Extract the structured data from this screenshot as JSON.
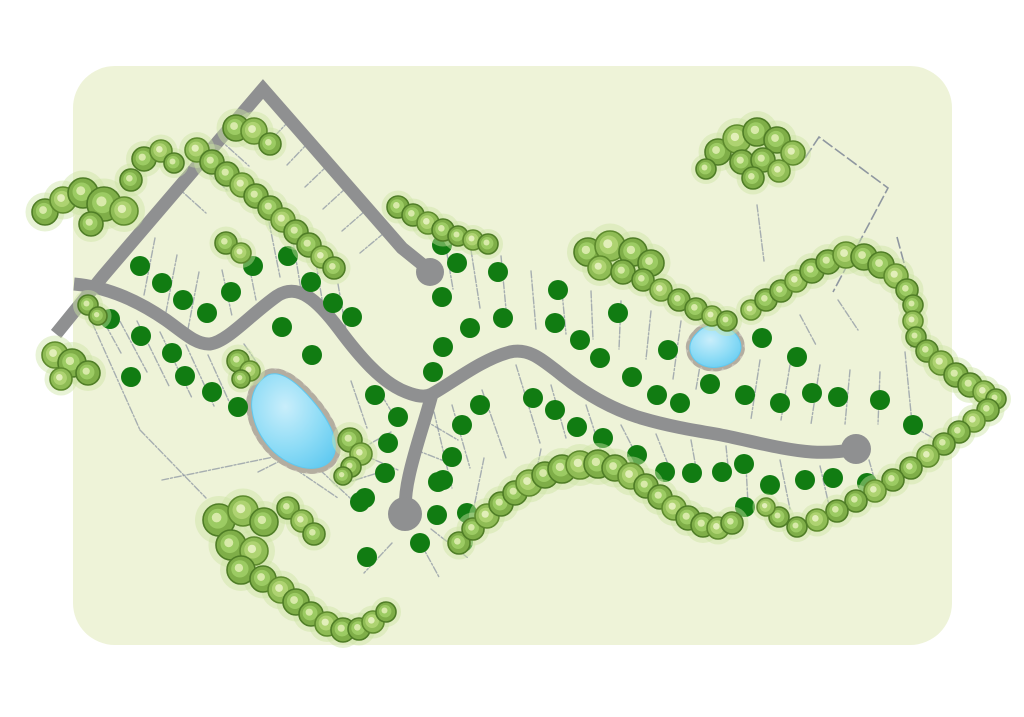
{
  "page": {
    "background": "#ffffff"
  },
  "panel": {
    "x": 73,
    "y": 66,
    "w": 879,
    "h": 579,
    "radius": 42,
    "fill": "#eef3d8"
  },
  "palette": {
    "road": "#8f9091",
    "lot_line": "#8790a0",
    "boundary_line": "#7e8696",
    "dot": "#117c12",
    "tree_dark": "#4f7d26",
    "tree_mid": "#7fae48",
    "tree_inner": "#9ccb63",
    "tree_light": "#d8eaa9",
    "tree_dark2": "#5d8a2d",
    "tree_mid2": "#8fbc55",
    "tree_inner2": "#aed371",
    "tree_light2": "#e2efb9",
    "tree_fringe": "#cde5a3",
    "pond_water": "#8edcf6",
    "pond_water_light": "#c9eefb",
    "pond_water_deep": "#5fc9f0",
    "pond_rim": "#c9c4b9",
    "pond_rim_dash": "#b3ada0"
  },
  "roads": {
    "width": 13,
    "north_road_points": "56,334 103,276 263,89 402,248 423,265",
    "main_road_path": "M 74 284 C 108 287 140 302 166 320 C 183 332 196 345 210 344 C 227 342 250 315 277 296 C 298 282 318 301 339 329 C 359 356 382 383 406 392 C 416 396 425 398 432 394 C 452 383 482 359 510 352 C 528 348 540 358 558 372 C 580 390 608 408 641 418 C 668 426 692 430 716 434 C 748 440 782 450 812 452 C 830 453 846 451 856 449",
    "south_spur_path": "M 432 394 C 426 418 415 448 409 476 C 406 489 405 500 405 512",
    "bulbs": [
      [
        430,
        272,
        14
      ],
      [
        405,
        514,
        17
      ],
      [
        856,
        449,
        15
      ]
    ]
  },
  "boundary_polylines": [
    [
      [
        805,
        158
      ],
      [
        819,
        137
      ],
      [
        888,
        188
      ],
      [
        833,
        292
      ]
    ],
    [
      [
        897,
        237
      ],
      [
        914,
        300
      ],
      [
        911,
        348
      ]
    ]
  ],
  "lot_lines": [
    [
      289,
      121,
      268,
      143
    ],
    [
      308,
      143,
      287,
      165
    ],
    [
      327,
      166,
      305,
      187
    ],
    [
      346,
      188,
      323,
      209
    ],
    [
      365,
      211,
      342,
      231
    ],
    [
      384,
      233,
      360,
      253
    ],
    [
      176,
      186,
      206,
      213
    ],
    [
      197,
      163,
      227,
      190
    ],
    [
      219,
      139,
      249,
      166
    ],
    [
      240,
      116,
      270,
      143
    ],
    [
      155,
      238,
      144,
      295
    ],
    [
      177,
      255,
      166,
      312
    ],
    [
      199,
      272,
      188,
      329
    ],
    [
      222,
      270,
      232,
      316
    ],
    [
      245,
      245,
      256,
      300
    ],
    [
      269,
      222,
      280,
      277
    ],
    [
      293,
      241,
      301,
      290
    ],
    [
      316,
      263,
      324,
      311
    ],
    [
      338,
      284,
      346,
      330
    ],
    [
      93,
      302,
      121,
      353
    ],
    [
      114,
      310,
      147,
      372
    ],
    [
      137,
      321,
      169,
      386
    ],
    [
      160,
      332,
      192,
      398
    ],
    [
      82,
      300,
      140,
      430
    ],
    [
      140,
      430,
      206,
      498
    ],
    [
      186,
      345,
      214,
      406
    ],
    [
      208,
      355,
      232,
      408
    ],
    [
      244,
      344,
      259,
      366
    ],
    [
      351,
      381,
      367,
      428
    ],
    [
      320,
      470,
      350,
      498
    ],
    [
      258,
      472,
      286,
      458
    ],
    [
      352,
      450,
      398,
      470
    ],
    [
      452,
      405,
      470,
      468
    ],
    [
      482,
      390,
      506,
      458
    ],
    [
      516,
      365,
      540,
      443
    ],
    [
      551,
      385,
      566,
      438
    ],
    [
      586,
      405,
      600,
      448
    ],
    [
      621,
      425,
      638,
      458
    ],
    [
      656,
      434,
      668,
      464
    ],
    [
      691,
      440,
      696,
      468
    ],
    [
      726,
      446,
      729,
      476
    ],
    [
      434,
      412,
      452,
      488
    ],
    [
      484,
      458,
      473,
      512
    ],
    [
      541,
      449,
      531,
      497
    ],
    [
      447,
      254,
      453,
      289
    ],
    [
      471,
      250,
      480,
      308
    ],
    [
      501,
      256,
      506,
      309
    ],
    [
      531,
      271,
      536,
      329
    ],
    [
      561,
      281,
      566,
      334
    ],
    [
      591,
      291,
      593,
      339
    ],
    [
      621,
      301,
      619,
      349
    ],
    [
      651,
      311,
      646,
      359
    ],
    [
      681,
      321,
      673,
      379
    ],
    [
      706,
      331,
      696,
      389
    ],
    [
      757,
      205,
      764,
      261
    ],
    [
      838,
      300,
      858,
      330
    ],
    [
      800,
      315,
      816,
      345
    ],
    [
      760,
      360,
      751,
      419
    ],
    [
      790,
      365,
      781,
      420
    ],
    [
      820,
      365,
      811,
      424
    ],
    [
      850,
      370,
      845,
      424
    ],
    [
      880,
      372,
      878,
      424
    ],
    [
      905,
      352,
      912,
      423
    ],
    [
      869,
      460,
      880,
      499
    ],
    [
      820,
      466,
      831,
      514
    ],
    [
      780,
      460,
      790,
      509
    ],
    [
      746,
      466,
      748,
      504
    ],
    [
      914,
      427,
      938,
      441
    ],
    [
      424,
      420,
      458,
      440
    ],
    [
      416,
      450,
      452,
      464
    ],
    [
      391,
      432,
      357,
      451
    ],
    [
      387,
      470,
      352,
      481
    ],
    [
      392,
      543,
      364,
      573
    ],
    [
      421,
      544,
      439,
      577
    ],
    [
      431,
      529,
      468,
      558
    ],
    [
      399,
      424,
      382,
      396
    ],
    [
      283,
      455,
      162,
      480
    ],
    [
      285,
      462,
      338,
      498
    ]
  ],
  "ponds": [
    {
      "name": "large-pond",
      "water_path": "M 268 375 C 256 382 250 396 252 410 C 254 426 262 440 274 452 C 286 463 302 470 316 468 C 330 466 337 456 335 442 C 333 428 324 414 312 400 C 300 386 282 369 268 375 Z",
      "rim_width": 11
    },
    {
      "name": "small-pond",
      "water_path": "M 697 333 C 703 326 714 323 724 327 C 734 330 741 338 741 348 C 740 358 731 365 719 367 C 707 369 695 364 691 354 C 688 346 691 339 697 333 Z",
      "rim_width": 8
    }
  ],
  "lot_markers": {
    "radius": 10,
    "points": [
      [
        140,
        266
      ],
      [
        162,
        283
      ],
      [
        183,
        300
      ],
      [
        207,
        313
      ],
      [
        231,
        292
      ],
      [
        253,
        266
      ],
      [
        288,
        256
      ],
      [
        311,
        282
      ],
      [
        333,
        303
      ],
      [
        352,
        317
      ],
      [
        110,
        319
      ],
      [
        141,
        336
      ],
      [
        172,
        353
      ],
      [
        131,
        377
      ],
      [
        185,
        376
      ],
      [
        212,
        392
      ],
      [
        238,
        407
      ],
      [
        282,
        327
      ],
      [
        312,
        355
      ],
      [
        442,
        245
      ],
      [
        457,
        263
      ],
      [
        498,
        272
      ],
      [
        442,
        297
      ],
      [
        470,
        328
      ],
      [
        503,
        318
      ],
      [
        443,
        347
      ],
      [
        433,
        372
      ],
      [
        558,
        290
      ],
      [
        555,
        323
      ],
      [
        580,
        340
      ],
      [
        600,
        358
      ],
      [
        618,
        313
      ],
      [
        533,
        398
      ],
      [
        632,
        377
      ],
      [
        668,
        350
      ],
      [
        657,
        395
      ],
      [
        710,
        384
      ],
      [
        762,
        338
      ],
      [
        797,
        357
      ],
      [
        745,
        395
      ],
      [
        780,
        403
      ],
      [
        812,
        393
      ],
      [
        838,
        397
      ],
      [
        880,
        400
      ],
      [
        913,
        425
      ],
      [
        744,
        464
      ],
      [
        770,
        485
      ],
      [
        805,
        480
      ],
      [
        833,
        478
      ],
      [
        867,
        483
      ],
      [
        745,
        507
      ],
      [
        722,
        472
      ],
      [
        692,
        473
      ],
      [
        665,
        472
      ],
      [
        637,
        455
      ],
      [
        603,
        438
      ],
      [
        577,
        427
      ],
      [
        555,
        410
      ],
      [
        680,
        403
      ],
      [
        375,
        395
      ],
      [
        398,
        417
      ],
      [
        388,
        443
      ],
      [
        385,
        473
      ],
      [
        365,
        498
      ],
      [
        443,
        480
      ],
      [
        452,
        457
      ],
      [
        462,
        425
      ],
      [
        480,
        405
      ],
      [
        438,
        482
      ],
      [
        437,
        515
      ],
      [
        420,
        543
      ],
      [
        463,
        542
      ],
      [
        467,
        513
      ],
      [
        360,
        502
      ],
      [
        367,
        557
      ]
    ]
  },
  "tree_clusters": [
    {
      "name": "northwest-row",
      "trees": [
        [
          45,
          212,
          13
        ],
        [
          63,
          200,
          13
        ],
        [
          83,
          193,
          15
        ],
        [
          104,
          204,
          17
        ],
        [
          124,
          211,
          14
        ],
        [
          91,
          224,
          12
        ],
        [
          144,
          159,
          12
        ],
        [
          161,
          151,
          11
        ],
        [
          174,
          163,
          10
        ],
        [
          131,
          180,
          11
        ]
      ]
    },
    {
      "name": "north-road-inner-row",
      "trees": [
        [
          197,
          150,
          12
        ],
        [
          212,
          162,
          12
        ],
        [
          227,
          174,
          12
        ],
        [
          242,
          185,
          12
        ],
        [
          256,
          196,
          12
        ],
        [
          270,
          208,
          12
        ],
        [
          283,
          220,
          12
        ],
        [
          296,
          232,
          12
        ],
        [
          309,
          245,
          12
        ],
        [
          322,
          257,
          11
        ],
        [
          334,
          268,
          11
        ]
      ]
    },
    {
      "name": "apex-clump",
      "trees": [
        [
          236,
          128,
          13
        ],
        [
          254,
          131,
          13
        ],
        [
          270,
          144,
          11
        ]
      ]
    },
    {
      "name": "crest-pair",
      "trees": [
        [
          226,
          243,
          11
        ],
        [
          241,
          253,
          10
        ]
      ]
    },
    {
      "name": "mid-north-row",
      "trees": [
        [
          398,
          207,
          11
        ],
        [
          413,
          215,
          11
        ],
        [
          428,
          223,
          11
        ],
        [
          443,
          230,
          11
        ],
        [
          458,
          236,
          10
        ],
        [
          473,
          240,
          10
        ],
        [
          488,
          244,
          10
        ]
      ]
    },
    {
      "name": "central-grove",
      "trees": [
        [
          588,
          252,
          14
        ],
        [
          610,
          246,
          15
        ],
        [
          633,
          252,
          14
        ],
        [
          651,
          263,
          13
        ],
        [
          600,
          268,
          12
        ],
        [
          623,
          272,
          12
        ],
        [
          643,
          280,
          11
        ],
        [
          661,
          290,
          11
        ],
        [
          679,
          300,
          11
        ],
        [
          696,
          309,
          11
        ],
        [
          712,
          316,
          10
        ],
        [
          727,
          321,
          10
        ]
      ]
    },
    {
      "name": "northeast-grove",
      "trees": [
        [
          718,
          152,
          13
        ],
        [
          737,
          139,
          14
        ],
        [
          757,
          132,
          14
        ],
        [
          777,
          140,
          13
        ],
        [
          793,
          153,
          12
        ],
        [
          742,
          162,
          12
        ],
        [
          763,
          160,
          12
        ],
        [
          779,
          171,
          11
        ],
        [
          753,
          178,
          11
        ],
        [
          706,
          169,
          10
        ]
      ]
    },
    {
      "name": "east-boundary-chain",
      "trees": [
        [
          751,
          310,
          10
        ],
        [
          766,
          300,
          11
        ],
        [
          781,
          291,
          11
        ],
        [
          796,
          281,
          11
        ],
        [
          812,
          271,
          12
        ],
        [
          828,
          262,
          12
        ],
        [
          846,
          255,
          13
        ],
        [
          864,
          257,
          13
        ],
        [
          881,
          265,
          13
        ],
        [
          896,
          276,
          12
        ],
        [
          907,
          290,
          11
        ],
        [
          913,
          305,
          10
        ],
        [
          913,
          321,
          10
        ],
        [
          916,
          337,
          10
        ],
        [
          927,
          351,
          11
        ],
        [
          941,
          363,
          12
        ],
        [
          956,
          375,
          12
        ],
        [
          970,
          385,
          12
        ],
        [
          984,
          392,
          11
        ],
        [
          996,
          399,
          10
        ],
        [
          988,
          410,
          11
        ],
        [
          974,
          421,
          11
        ],
        [
          959,
          432,
          11
        ],
        [
          944,
          444,
          11
        ],
        [
          928,
          456,
          11
        ],
        [
          911,
          468,
          11
        ],
        [
          893,
          480,
          11
        ],
        [
          875,
          491,
          11
        ],
        [
          856,
          501,
          11
        ],
        [
          837,
          511,
          11
        ],
        [
          817,
          520,
          11
        ],
        [
          797,
          527,
          10
        ],
        [
          779,
          517,
          10
        ],
        [
          766,
          507,
          9
        ]
      ]
    },
    {
      "name": "south-arc",
      "trees": [
        [
          459,
          543,
          11
        ],
        [
          473,
          529,
          11
        ],
        [
          487,
          516,
          12
        ],
        [
          501,
          504,
          12
        ],
        [
          515,
          493,
          12
        ],
        [
          529,
          483,
          13
        ],
        [
          545,
          475,
          13
        ],
        [
          562,
          469,
          14
        ],
        [
          580,
          465,
          14
        ],
        [
          598,
          464,
          14
        ],
        [
          615,
          468,
          13
        ],
        [
          631,
          476,
          13
        ],
        [
          646,
          486,
          12
        ],
        [
          660,
          497,
          12
        ],
        [
          674,
          508,
          12
        ],
        [
          688,
          518,
          12
        ],
        [
          703,
          525,
          12
        ],
        [
          718,
          528,
          11
        ],
        [
          732,
          523,
          11
        ]
      ]
    },
    {
      "name": "southwest-grove",
      "trees": [
        [
          219,
          520,
          16
        ],
        [
          243,
          511,
          15
        ],
        [
          264,
          522,
          14
        ],
        [
          231,
          545,
          15
        ],
        [
          254,
          551,
          14
        ],
        [
          241,
          570,
          14
        ],
        [
          263,
          579,
          13
        ],
        [
          281,
          590,
          13
        ],
        [
          296,
          602,
          13
        ],
        [
          311,
          614,
          12
        ],
        [
          327,
          624,
          12
        ],
        [
          343,
          630,
          12
        ],
        [
          359,
          629,
          11
        ],
        [
          373,
          622,
          11
        ],
        [
          386,
          612,
          10
        ],
        [
          288,
          508,
          11
        ],
        [
          302,
          521,
          11
        ],
        [
          314,
          534,
          11
        ]
      ]
    },
    {
      "name": "pond-west-clump",
      "trees": [
        [
          238,
          361,
          11
        ],
        [
          250,
          371,
          10
        ],
        [
          241,
          379,
          9
        ]
      ]
    },
    {
      "name": "pond-east-clump",
      "trees": [
        [
          350,
          440,
          12
        ],
        [
          361,
          454,
          11
        ],
        [
          351,
          467,
          10
        ],
        [
          343,
          476,
          9
        ]
      ]
    },
    {
      "name": "west-edge-clumps",
      "trees": [
        [
          55,
          355,
          13
        ],
        [
          72,
          363,
          14
        ],
        [
          88,
          373,
          12
        ],
        [
          61,
          379,
          11
        ],
        [
          88,
          305,
          10
        ],
        [
          98,
          316,
          9
        ]
      ]
    }
  ]
}
